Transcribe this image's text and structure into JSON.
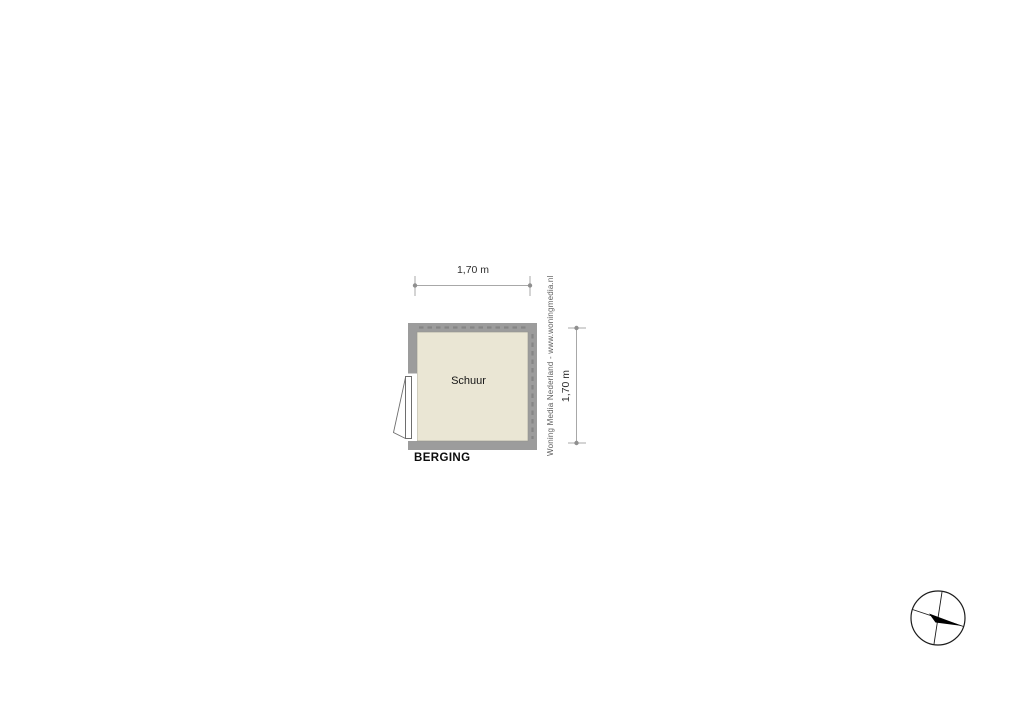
{
  "floorplan": {
    "room_label": "Schuur",
    "plan_label": "BERGING",
    "dimensions": {
      "width": {
        "label": "1,70 m"
      },
      "height": {
        "label": "1,70 m"
      }
    },
    "watermark": "Woning Media Nederland - www.woningmedia.nl",
    "icons": {
      "compass": "compass-rose-icon"
    },
    "colors": {
      "background": "#ffffff",
      "wall": "#9c9c9c",
      "wall_hatch": "#858585",
      "floor": "#eae6d4",
      "dimension_line": "#a8a8a8",
      "dimension_dot": "#8f8f8f",
      "door_outline": "#6e6e6e",
      "label_text": "#0d0d0d",
      "watermark_text": "#606060",
      "compass_outline": "#1c1c1c",
      "compass_needle": "#000000"
    }
  }
}
